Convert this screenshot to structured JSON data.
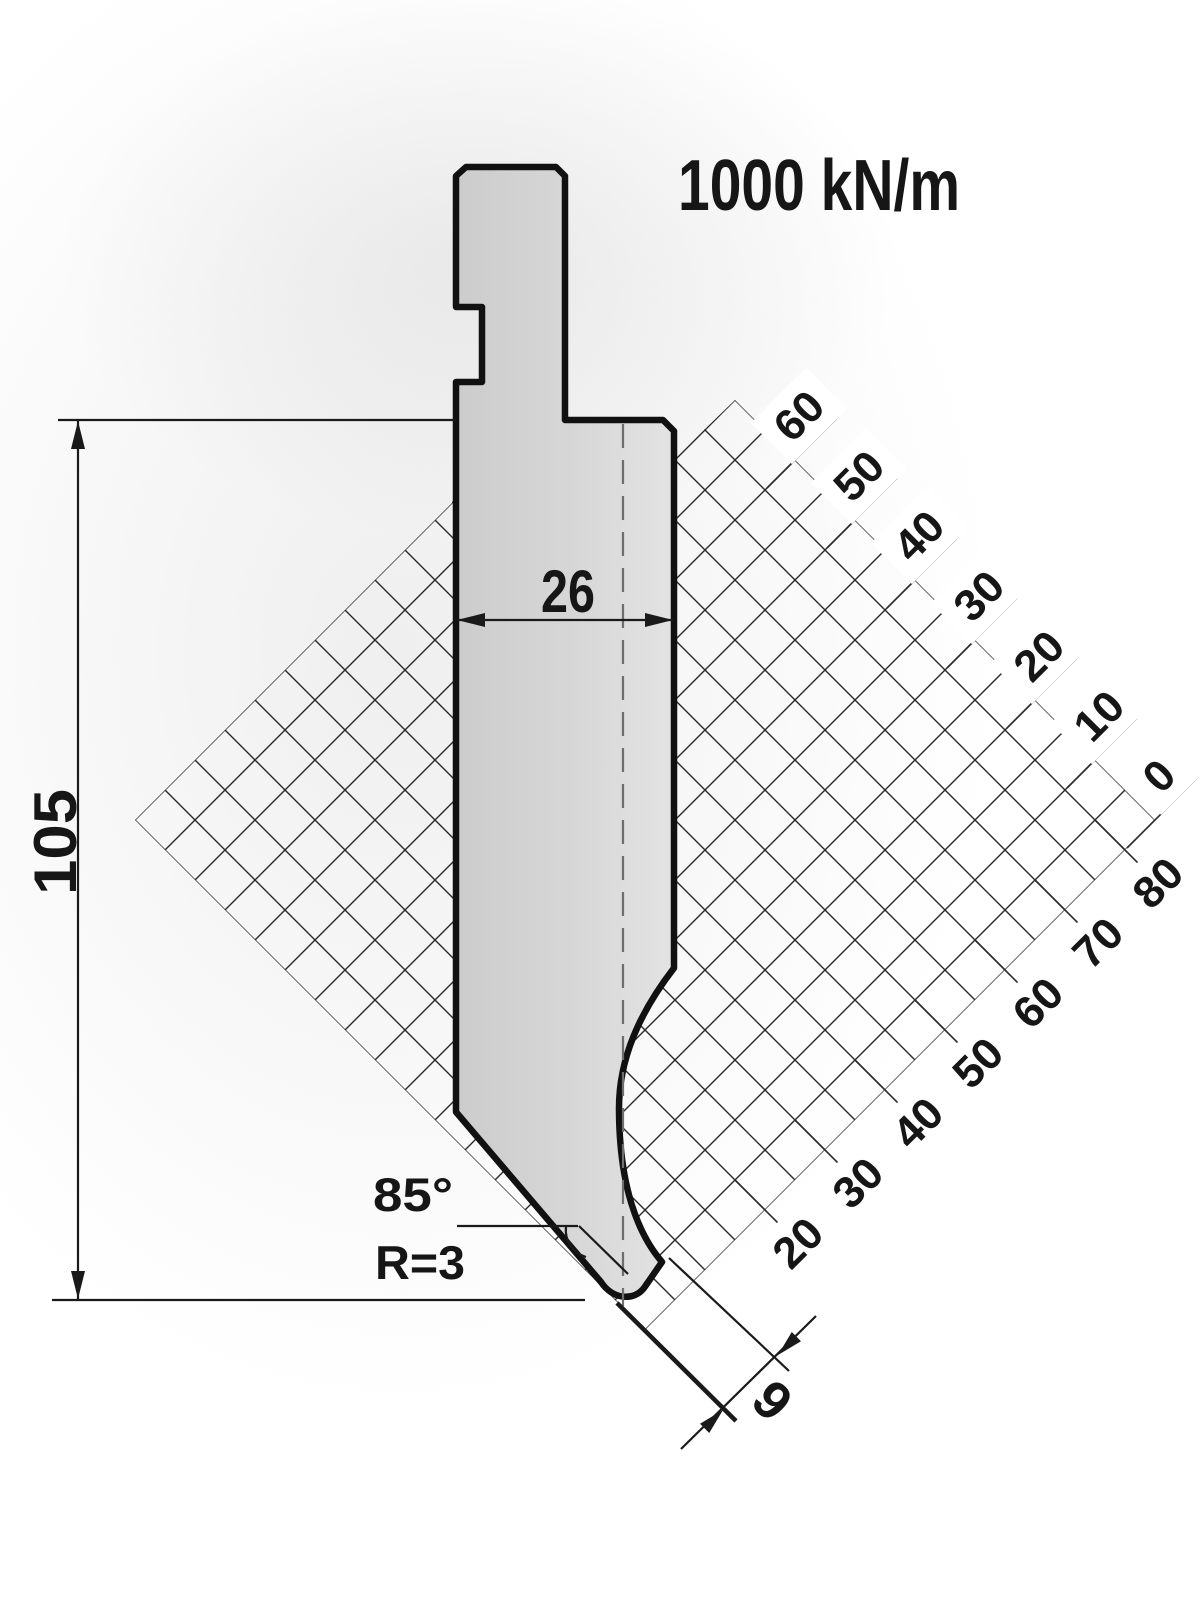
{
  "drawing": {
    "force_rating": "1000 kN/m",
    "dimensions": {
      "height": "105",
      "body_width": "26",
      "tip_angle": "85°",
      "tip_radius": "R=3",
      "tip_width": "9"
    }
  },
  "grid": {
    "top_edge_labels": [
      "0",
      "10",
      "20",
      "30",
      "40",
      "50",
      "60"
    ],
    "bottom_edge_labels": [
      "20",
      "30",
      "40",
      "50",
      "60",
      "70",
      "80"
    ],
    "c_min": 955,
    "c_max": 1975,
    "d_min": -685,
    "d_max": 335,
    "step": 60,
    "label_step": 120
  },
  "colors": {
    "background": "#ffffff",
    "ink": "#161616",
    "outline": "#111111",
    "dim_line": "#1a1a1a",
    "grid_line": "#2b2b2b",
    "centerline": "#6e6e6e",
    "fill_dark": "#cccccc",
    "fill_light": "#e3e3e3"
  }
}
